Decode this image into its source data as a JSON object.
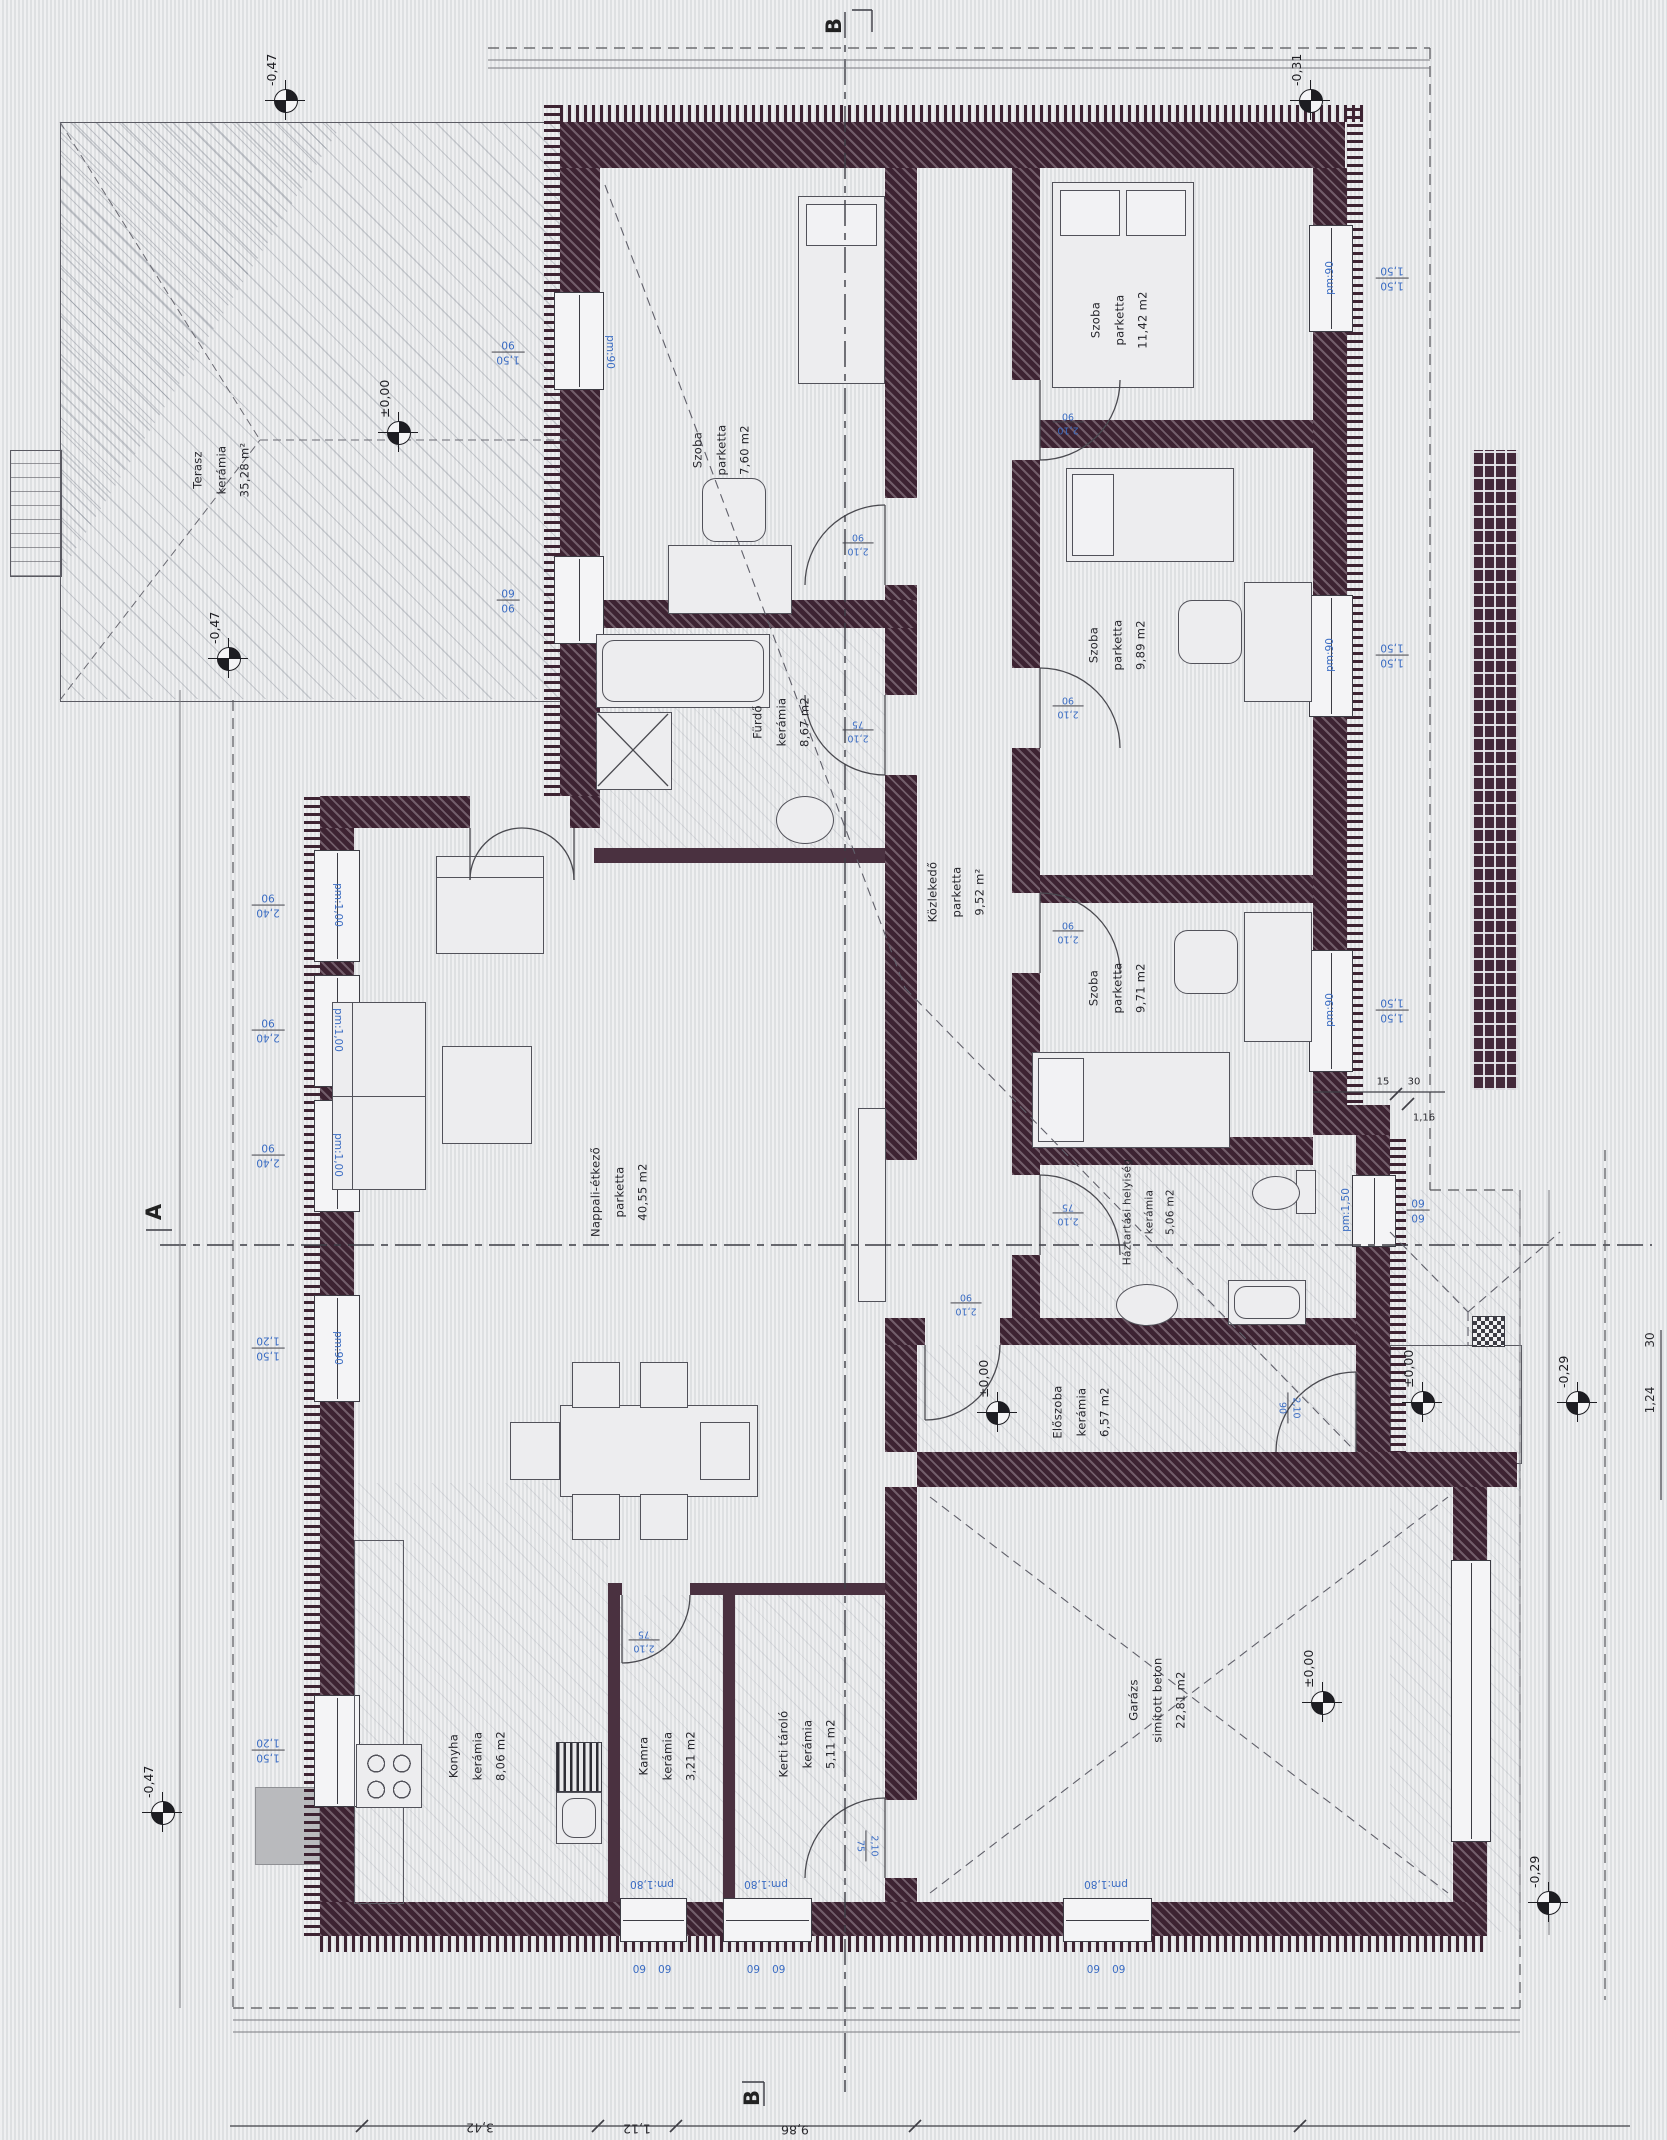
{
  "rooms": [
    {
      "name": "Szoba",
      "floor": "parketta",
      "area": "7,60 m2"
    },
    {
      "name": "Szoba",
      "floor": "parketta",
      "area": "11,42 m2"
    },
    {
      "name": "Szoba",
      "floor": "parketta",
      "area": "9,89 m2"
    },
    {
      "name": "Szoba",
      "floor": "parketta",
      "area": "9,71 m2"
    },
    {
      "name": "Fürdő",
      "floor": "kerámia",
      "area": "8,67 m2"
    },
    {
      "name": "Közlekedő",
      "floor": "parketta",
      "area": "9,52 m²"
    },
    {
      "name": "Nappali-étkező",
      "floor": "parketta",
      "area": "40,55 m2"
    },
    {
      "name": "Háztartási helyiség",
      "floor": "kerámia",
      "area": "5,06 m2"
    },
    {
      "name": "Előszoba",
      "floor": "kerámia",
      "area": "6,57 m2"
    },
    {
      "name": "Konyha",
      "floor": "kerámia",
      "area": "8,06 m2"
    },
    {
      "name": "Kamra",
      "floor": "kerámia",
      "area": "3,21 m2"
    },
    {
      "name": "Kerti tároló",
      "floor": "kerámia",
      "area": "5,11 m2"
    },
    {
      "name": "Garázs",
      "floor": "simított beton",
      "area": "22,81 m2"
    },
    {
      "name": "Terasz",
      "floor": "kerámia",
      "area": "35,28 m²"
    }
  ],
  "elevations": [
    "-0,47",
    "±0,00",
    "-0,47",
    "-0,47",
    "±0,00",
    "±0,00",
    "±0,00",
    "-0,29",
    "-0,29",
    "-0,31"
  ],
  "window_dims": [
    {
      "a": "1,50",
      "b": "90"
    },
    {
      "a": "90",
      "b": "60"
    },
    {
      "a": "2,40",
      "b": "90"
    },
    {
      "a": "2,40",
      "b": "90"
    },
    {
      "a": "2,40",
      "b": "90"
    },
    {
      "a": "1,50",
      "b": "1,20"
    },
    {
      "a": "1,50",
      "b": "1,20"
    },
    {
      "a": "1,50",
      "b": "1,50"
    },
    {
      "a": "1,50",
      "b": "1,50"
    },
    {
      "a": "1,50",
      "b": "1,50"
    },
    {
      "a": "60",
      "b": "60"
    },
    {
      "a": "60",
      "b": "60"
    },
    {
      "a": "60",
      "b": "60"
    },
    {
      "a": "60",
      "b": "60"
    }
  ],
  "door_dims": [
    {
      "a": "2,10",
      "b": "90"
    },
    {
      "a": "2,10",
      "b": "75"
    },
    {
      "a": "2,10",
      "b": "90"
    },
    {
      "a": "2,10",
      "b": "90"
    },
    {
      "a": "2,10",
      "b": "90"
    },
    {
      "a": "2,10",
      "b": "75"
    },
    {
      "a": "2,10",
      "b": "90"
    },
    {
      "a": "2,10",
      "b": "90"
    },
    {
      "a": "2,10",
      "b": "75"
    },
    {
      "a": "2,10",
      "b": "75"
    }
  ],
  "pm_labels": {
    "p90": "pm:90",
    "p100": "pm:1,00",
    "p150": "pm:1,50",
    "p180": "pm:1,80"
  },
  "chains": {
    "bottom": [
      "3,42",
      "1,12",
      "9,86"
    ],
    "right": [
      "1,24",
      "30"
    ],
    "step": [
      "15",
      "30",
      "1,16"
    ]
  },
  "sections": {
    "b": "B",
    "a": "A"
  },
  "colors": {
    "wall": "#3d2332",
    "dim_blue": "#3a6cc3",
    "paper": "#e4e5e7"
  }
}
